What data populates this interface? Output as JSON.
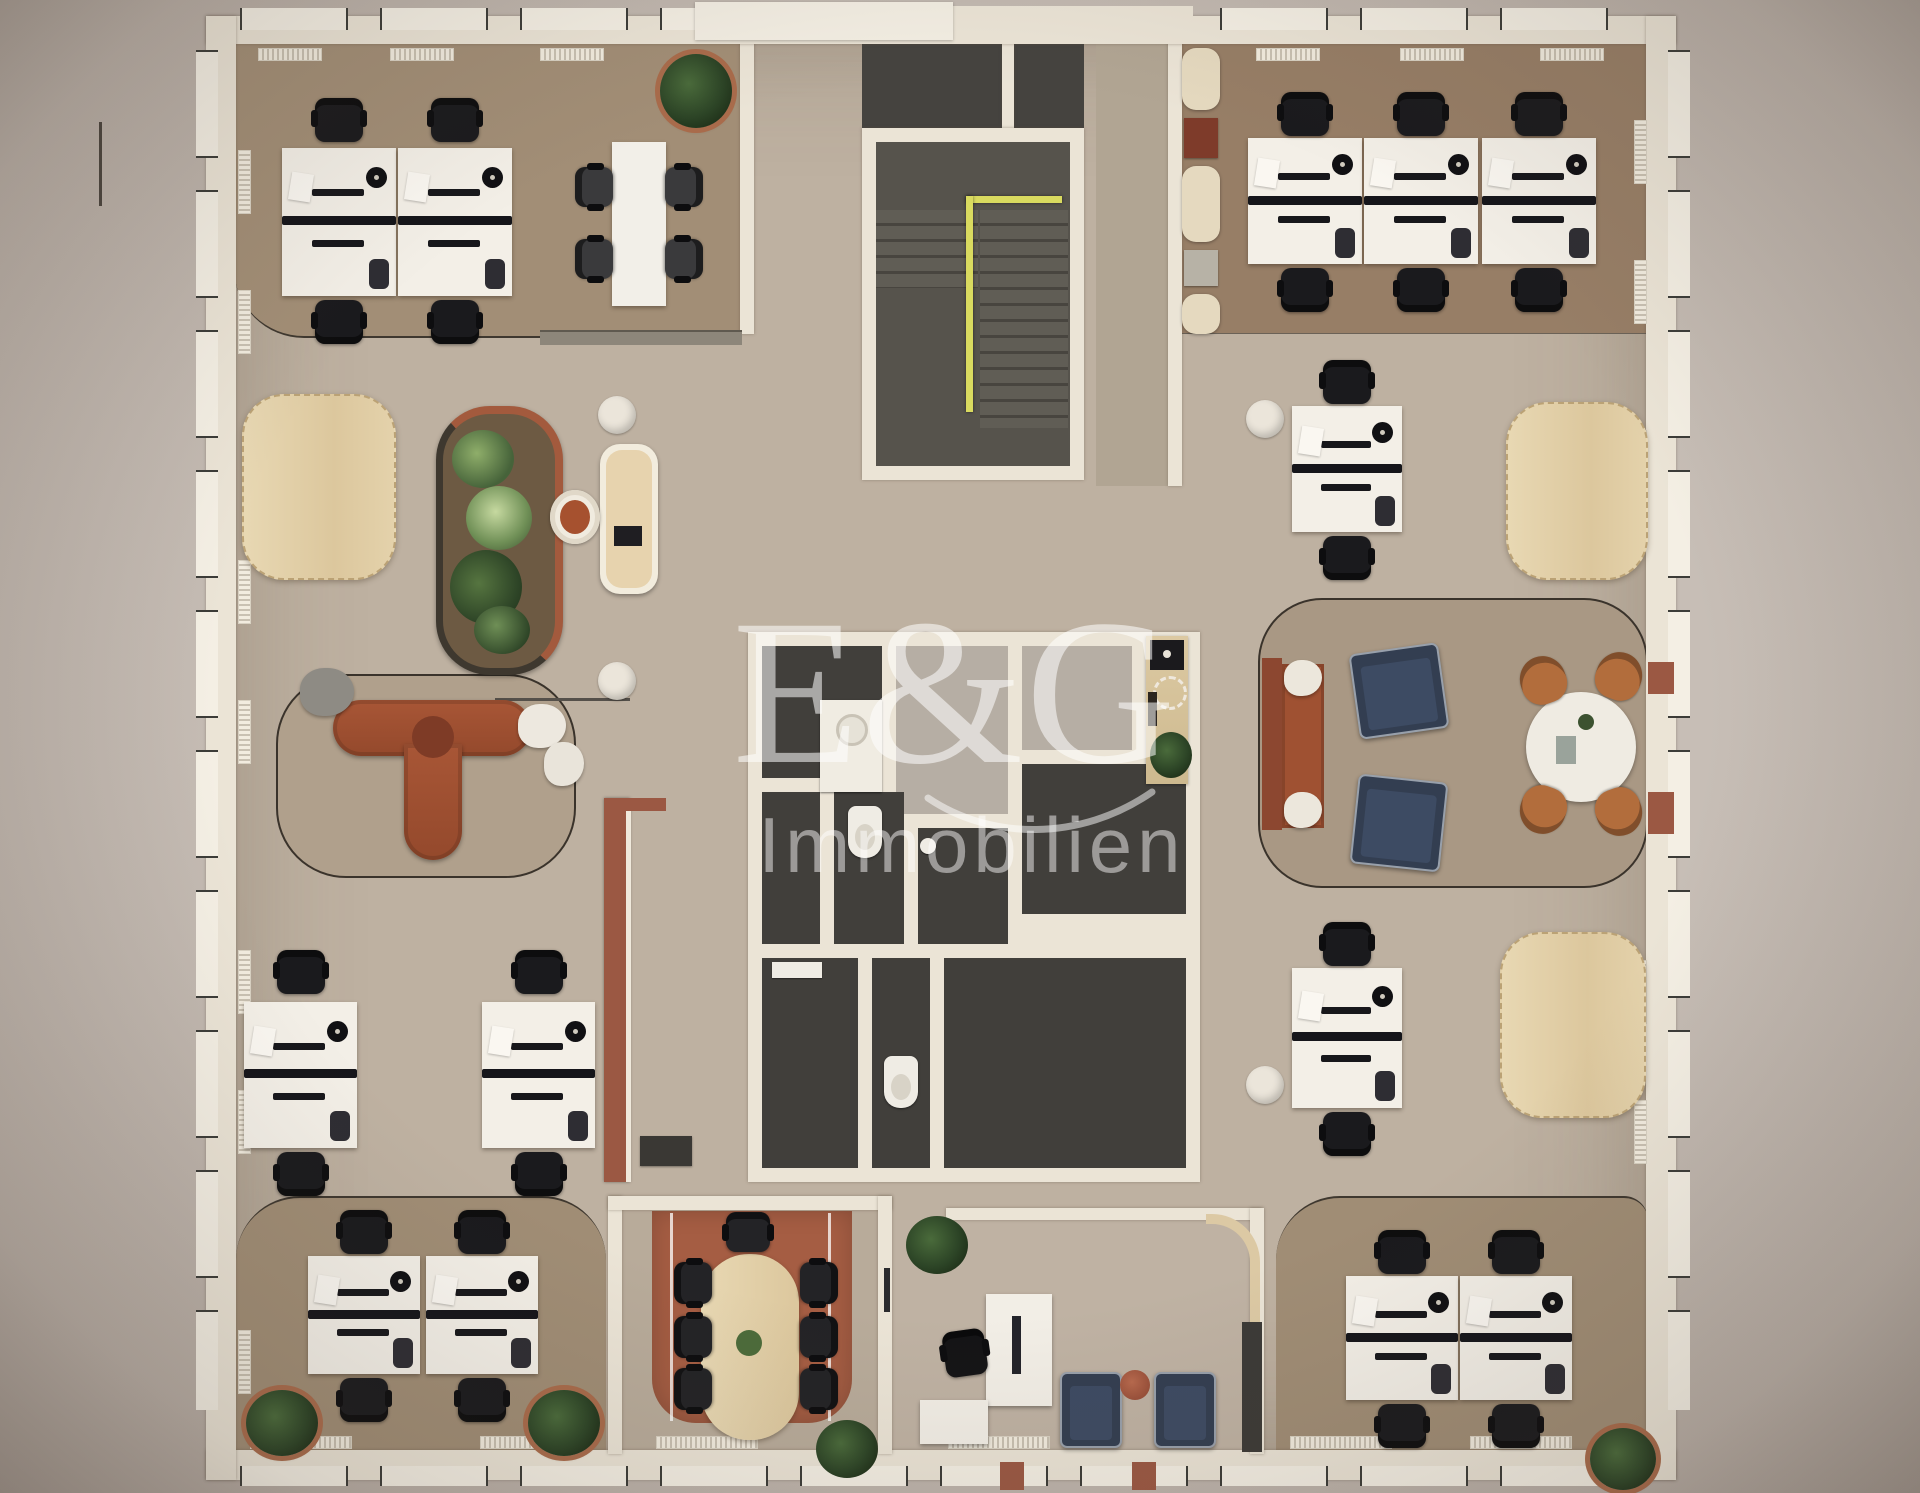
{
  "watermark": {
    "logo": "E&G",
    "subtitle": "Immobilien",
    "color": "#ffffff",
    "opacity": 0.55
  },
  "scene": {
    "type": "3d-rendered-office-floor-plan",
    "view": "top-down"
  },
  "palette": {
    "bg": "#c7beb6",
    "bg_edge": "#b0a59c",
    "wall": "#ebe4d6",
    "window": "#f4efe4",
    "floor": "#beb1a1",
    "floor_nw": "#a28e76",
    "floor_ne": "#977e66",
    "floor_sw": "#a08d75",
    "floor_lounge": "#a99884",
    "floor_sofa": "#b0a08c",
    "floor_meeting": "#b8ab9a",
    "rug": "#a55d43",
    "floor_wc": "#413f3b",
    "floor_gray": "#b6aea4",
    "floor_stair": "#56534c",
    "floor_corridor": "#b1a593",
    "desk": "#f3efe7",
    "chair": "#1a1a1d",
    "wood": "#e3d0a9",
    "sofa_rust": "#9f5132",
    "navy": "#333e51",
    "caramel": "#b26d3c",
    "yellow": "#d9da5f",
    "accent_rust": "#9b5843",
    "cream": "#e5d9bf"
  },
  "inventory": {
    "core": [
      "entrance vestibule",
      "staircase with yellow handrail",
      "corridor",
      "wc block with toilets and sinks",
      "kitchenette counter with coffee machine"
    ],
    "offices": [
      {
        "id": "north-west",
        "workstations": 4,
        "extras": [
          "meeting table with 4 chairs",
          "potted plant",
          "sideboard"
        ]
      },
      {
        "id": "north-east",
        "workstations": 6,
        "extras": [
          "booth seating row with 2 tables"
        ]
      },
      {
        "id": "south-west",
        "workstations": 4,
        "extras": [
          "2 potted plants"
        ]
      },
      {
        "id": "south-east",
        "workstations": 4,
        "extras": [
          "potted plant"
        ]
      }
    ],
    "open_space": [
      "rounded wood table west",
      "green room-divider planter",
      "admin desk with chair and laptop",
      "2 round poufs",
      "rust modular sofa island with side tables",
      "2 standalone double desks west",
      "2 standalone double desks east",
      "2 rounded wood tables east"
    ],
    "lounge_east": [
      "rust sofa",
      "2 navy armchairs",
      "round white table",
      "4 caramel tub chairs"
    ],
    "meeting_room": [
      "oval wood table",
      "7 black chairs",
      "terracotta rug",
      "wall screen",
      "plant"
    ],
    "reception": [
      "white reception desk",
      "task chair",
      "2 navy armchairs",
      "round side table",
      "curved wood cloak panel",
      "cabinet",
      "plant"
    ]
  }
}
